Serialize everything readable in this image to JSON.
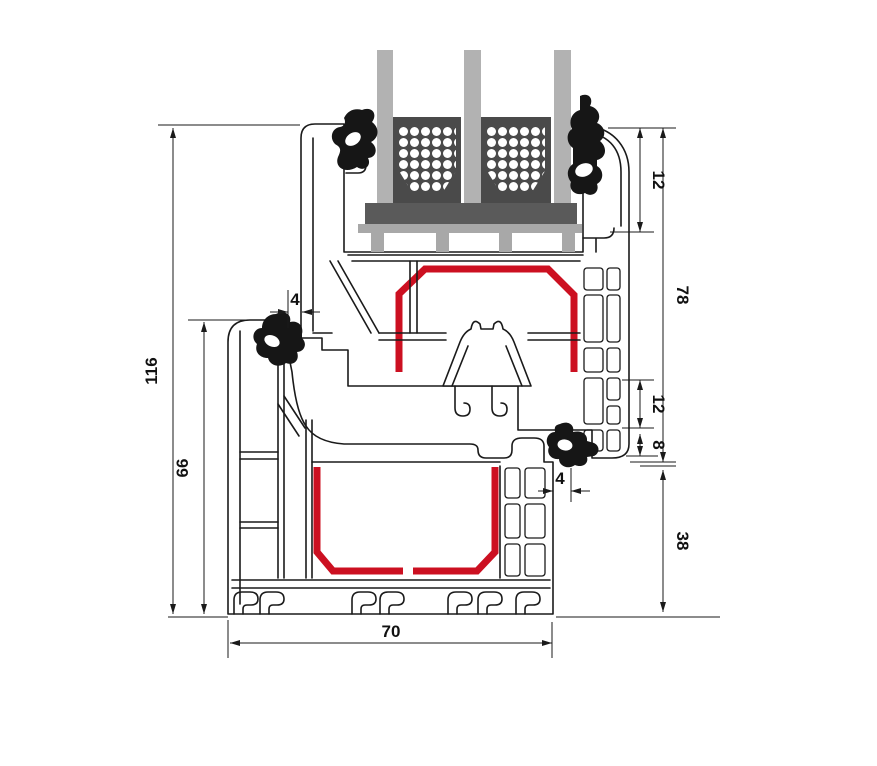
{
  "drawing": {
    "type": "window-profile-cross-section",
    "dimensions": {
      "overall_height": "116",
      "frame_height": "66",
      "top_gasket_gap": "4",
      "glazing_bead": "12",
      "sash_overall": "78",
      "lock_chamber": "12",
      "groove": "8",
      "bottom_gasket_gap": "4",
      "frame_face_below_sash": "38",
      "profile_depth": "70"
    },
    "colors": {
      "outline": "#1a1a1a",
      "steel_reinforcement": "#cc1021",
      "glass": "#b2b2b2",
      "spacer": "#4a4a4a",
      "glazing_block": "#5a5a5a",
      "bridge": "#a8a8a8",
      "gasket": "#161616",
      "background": "#ffffff"
    },
    "glazing": {
      "pane_count": 3,
      "spacer_count": 2
    }
  }
}
